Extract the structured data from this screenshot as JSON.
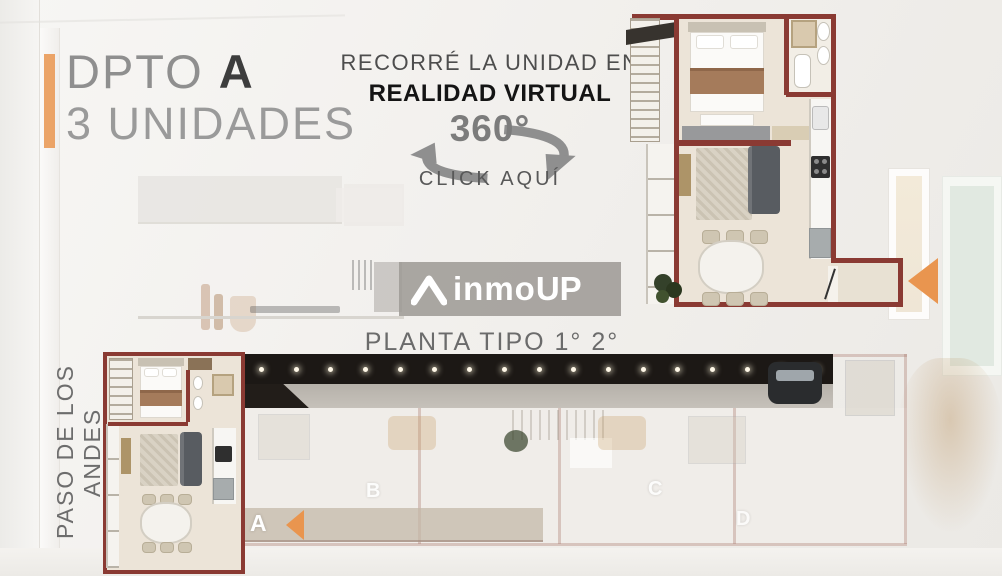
{
  "colors": {
    "accent": "#e9954f",
    "wall": "#8a3a33",
    "corridor": "#1c1815"
  },
  "header": {
    "title_prefix": "DPTO ",
    "title_letter": "A",
    "subtitle": "3 UNIDADES"
  },
  "vr": {
    "line1": "RECORRÉ LA UNIDAD EN",
    "line2": "REALIDAD VIRTUAL",
    "badge": "360°",
    "cta": "CLICK AQUÍ"
  },
  "brand": {
    "name_main": "inmo",
    "name_suffix": "UP"
  },
  "plan": {
    "floor_label": "PLANTA TIPO 1° 2° 3°",
    "street_label": "PASO DE LOS ANDES",
    "units": {
      "a": "A",
      "b": "B",
      "c": "C",
      "d": "D"
    }
  }
}
